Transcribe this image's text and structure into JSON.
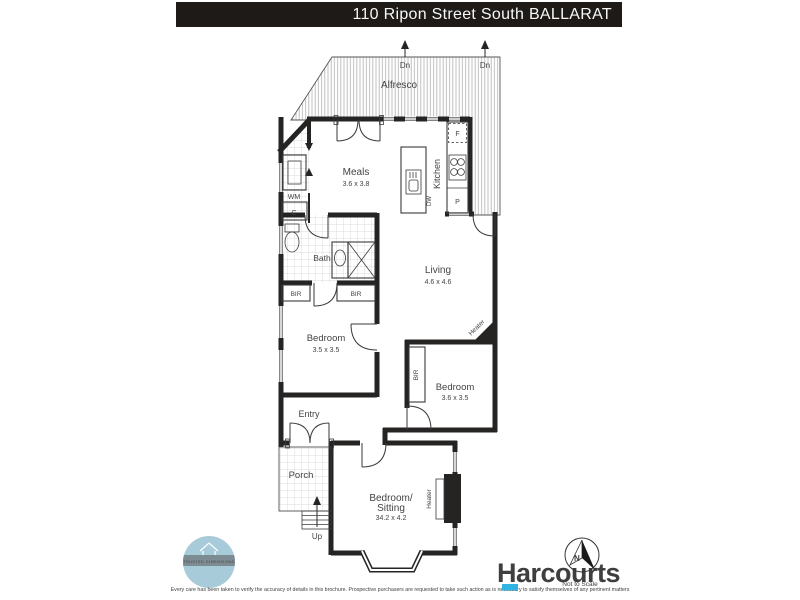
{
  "title_bar": {
    "text": "110 Ripon Street South BALLARAT"
  },
  "plan": {
    "alfresco": "Alfresco",
    "dn": "Dn",
    "up": "Up",
    "meals": {
      "name": "Meals",
      "dims": "3.6 x 3.8"
    },
    "kitchen": {
      "name": "Kitchen",
      "fridge": "F",
      "pantry": "P",
      "dishwasher": "DW"
    },
    "laundry": {
      "washing_machine": "WM",
      "cupboard": "C"
    },
    "bath": {
      "name": "Bath"
    },
    "living": {
      "name": "Living",
      "dims": "4.6 x 4.6"
    },
    "bedroom1": {
      "name": "Bedroom",
      "dims": "3.5 x 3.5"
    },
    "bedroom2": {
      "name": "Bedroom",
      "dims": "3.6 x 3.5"
    },
    "bedroom_sitting": {
      "name_line1": "Bedroom/",
      "name_line2": "Sitting",
      "dims": "34.2 x 4.2"
    },
    "entry": "Entry",
    "porch": "Porch",
    "robe": "BIR",
    "heater": "Heater"
  },
  "footer": {
    "brand": "Harcourts",
    "not_to_scale": "Not to Scale",
    "compass": "N",
    "logo_band": "TRUSTED DIMENSIONS",
    "disclaimer": "Every care has been taken to verify the accuracy of details in this brochure. Prospective purchasers are requested to take such action as is necessary to satisfy themselves of any pertinent matters"
  },
  "colors": {
    "title_bar_bg": "#1d1a18",
    "wall": "#262323",
    "brand_navy": "#1a3a6d",
    "brand_cyan": "#33b3e3",
    "logo_blue": "#a7cbd9",
    "logo_band": "#7d8b92"
  }
}
